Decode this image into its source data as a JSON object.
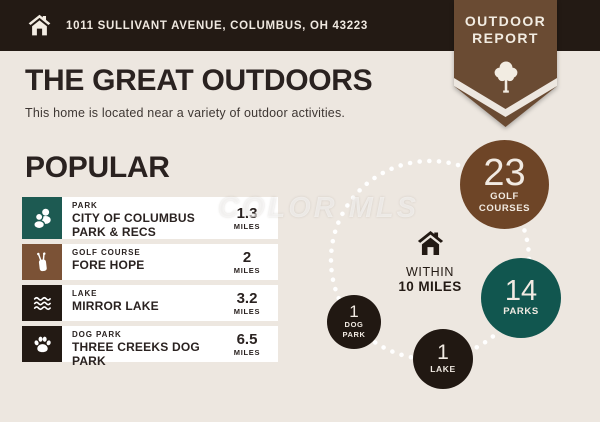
{
  "header": {
    "address": "1011 SULLIVANT AVENUE, COLUMBUS, OH 43223"
  },
  "badge": {
    "title_line1": "OUTDOOR",
    "title_line2": "REPORT",
    "icon": "tree-icon"
  },
  "intro": {
    "title": "THE GREAT OUTDOORS",
    "subtitle": "This home is located near a variety of outdoor activities."
  },
  "popular": {
    "heading": "POPULAR",
    "items": [
      {
        "category": "PARK",
        "name": "CITY OF COLUMBUS PARK & RECS",
        "distance": "1.3",
        "unit": "MILES",
        "icon": "park-people-icon",
        "icon_color": "#1D5A52"
      },
      {
        "category": "GOLF COURSE",
        "name": "FORE HOPE",
        "distance": "2",
        "unit": "MILES",
        "icon": "golf-bag-icon",
        "icon_color": "#7B5236"
      },
      {
        "category": "LAKE",
        "name": "MIRROR LAKE",
        "distance": "3.2",
        "unit": "MILES",
        "icon": "waves-icon",
        "icon_color": "#231A14"
      },
      {
        "category": "DOG PARK",
        "name": "THREE CREEKS DOG PARK",
        "distance": "6.5",
        "unit": "MILES",
        "icon": "paw-icon",
        "icon_color": "#231A14"
      }
    ]
  },
  "radius_viz": {
    "center_icon": "home-icon",
    "label_line1": "WITHIN",
    "label_line2": "10 MILES",
    "bubbles": [
      {
        "id": "golf-courses",
        "count": "23",
        "label_line1": "GOLF",
        "label_line2": "COURSES",
        "color": "#6E4527"
      },
      {
        "id": "parks",
        "count": "14",
        "label_line1": "PARKS",
        "color": "#11564F"
      },
      {
        "id": "lake",
        "count": "1",
        "label_line1": "LAKE",
        "color": "#211812"
      },
      {
        "id": "dog-park",
        "count": "1",
        "label_line1": "DOG",
        "label_line2": "PARK",
        "color": "#211812"
      }
    ]
  },
  "watermark": "COLOR MLS",
  "colors": {
    "background": "#EDE7E0",
    "header_bg": "#231A14",
    "badge_brown": "#6A4B33",
    "accent_teal": "#11564F",
    "accent_brown": "#6E4527",
    "circle_dark": "#211812",
    "card_bg": "#FFFFFF",
    "text_dark": "#2A2220",
    "text_cream": "#F0E9E1"
  }
}
